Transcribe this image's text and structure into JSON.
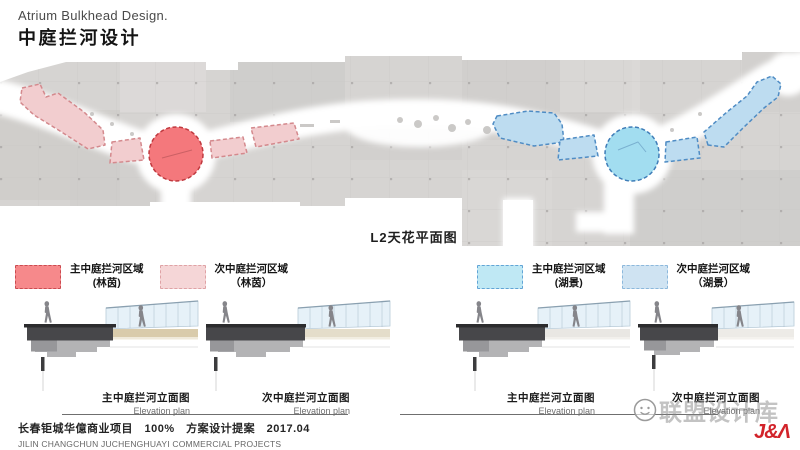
{
  "header": {
    "title_en": "Atrium Bulkhead Design.",
    "title_zh": "中庭拦河设计"
  },
  "plan": {
    "label": "L2天花平面图",
    "colors": {
      "main_forest": "#f4787c",
      "forest_border": "#c0393f",
      "sub_forest": "#f2cdcf",
      "sub_forest_border": "#d4898d",
      "main_lake": "#a2ddf0",
      "lake_border": "#3f7db8",
      "sub_lake": "#bddcf0",
      "sub_lake_border": "#4f8cc4"
    }
  },
  "legend": {
    "items": [
      {
        "label": "主中庭拦河区域",
        "sub": "(林茵)",
        "fill": "#f6898b",
        "border": "#ca4b50"
      },
      {
        "label": "次中庭拦河区域",
        "sub": "（林茵）",
        "fill": "#f5d6d7",
        "border": "#dfa2a5"
      },
      {
        "label": "主中庭拦河区域",
        "sub": "(湖景)",
        "fill": "#bfe8f4",
        "border": "#62a4d6"
      },
      {
        "label": "次中庭拦河区域",
        "sub": "（湖景）",
        "fill": "#cfe3f2",
        "border": "#8cb8dc"
      }
    ]
  },
  "elevations": [
    {
      "title": "主中庭拦河立面图",
      "subtitle": "Elevation plan"
    },
    {
      "title": "次中庭拦河立面图",
      "subtitle": "Elevation plan"
    },
    {
      "title": "主中庭拦河立面图",
      "subtitle": "Elevation plan"
    },
    {
      "title": "次中庭拦河立面图",
      "subtitle": "Elevation plan"
    }
  ],
  "footer": {
    "project_zh": "长春钜城华億商业项目　100%　方案设计提案　2017.04",
    "project_en": "JILIN CHANGCHUN JUCHENGHUAYI COMMERCIAL PROJECTS"
  },
  "watermark": {
    "text": "联盟设计库",
    "logo": "J&Λ",
    "logo_color": "#d2232a"
  }
}
